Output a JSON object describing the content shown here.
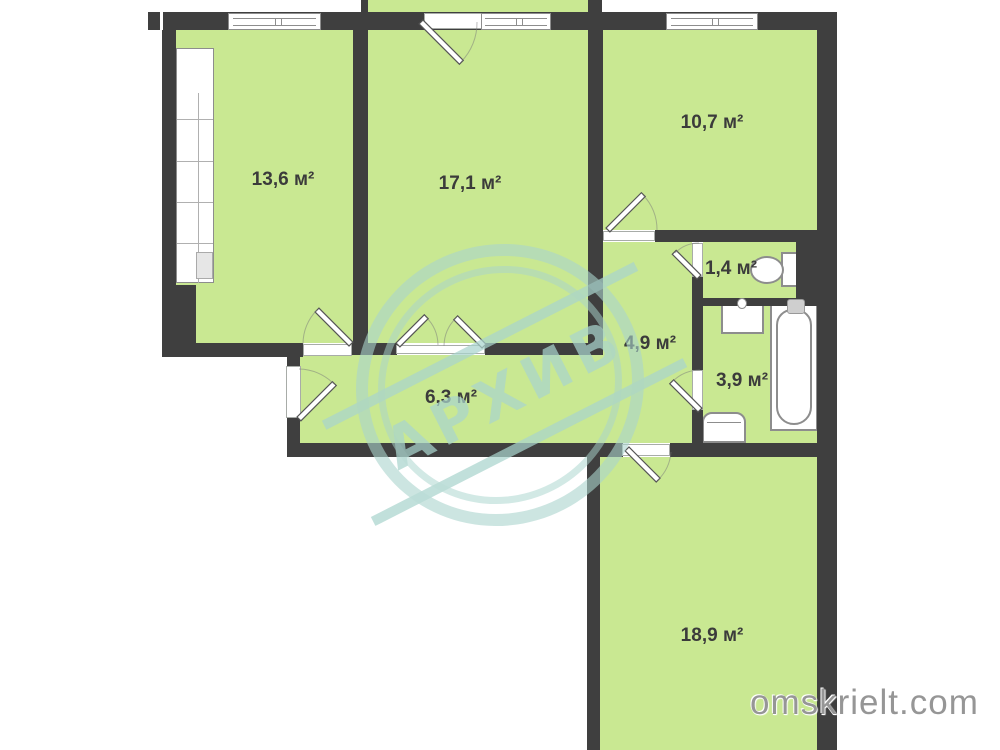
{
  "plan": {
    "rooms": [
      {
        "id": "kitchen",
        "area": "13,6 м²"
      },
      {
        "id": "living-room",
        "area": "17,1 м²"
      },
      {
        "id": "bedroom",
        "area": "10,7 м²"
      },
      {
        "id": "wc",
        "area": "1,4 м²"
      },
      {
        "id": "hallway",
        "area": "4,9 м²"
      },
      {
        "id": "bathroom",
        "area": "3,9 м²"
      },
      {
        "id": "corridor",
        "area": "6,3 м²"
      },
      {
        "id": "big-room",
        "area": "18,9 м²"
      }
    ]
  },
  "watermark": {
    "stamp_text": "АРХИВ",
    "site_text": "omskrielt.com"
  },
  "colors": {
    "wall": "#3f3f3f",
    "room_fill": "#c9e892",
    "fixture_outline": "#8d8d8d",
    "stamp": "#a9d4cc",
    "label_text": "#3b3b3b",
    "site_text": "#969696",
    "background": "#ffffff"
  }
}
